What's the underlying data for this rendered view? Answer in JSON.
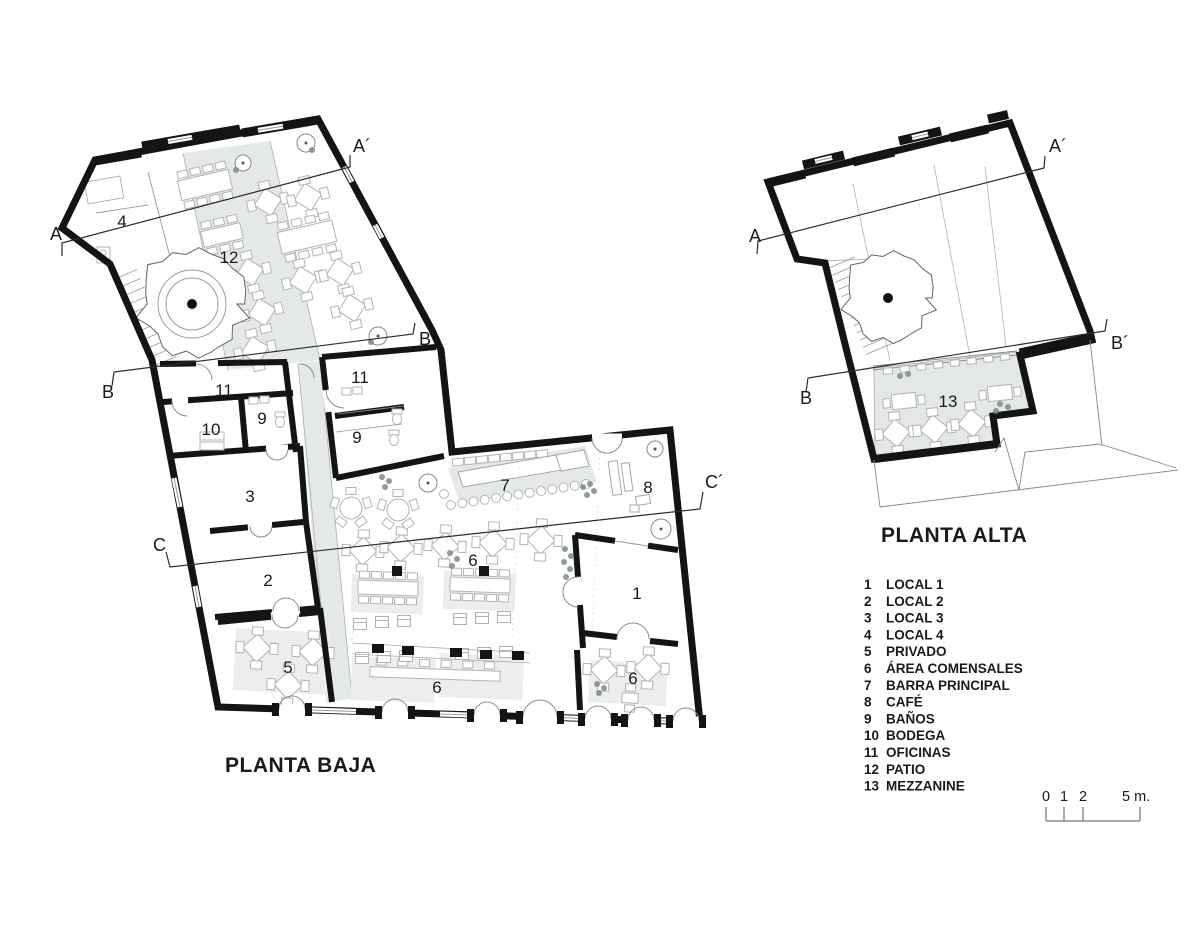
{
  "titles": {
    "ground_floor": "PLANTA BAJA",
    "upper_floor": "PLANTA ALTA"
  },
  "legend": {
    "items": [
      {
        "number": "1",
        "label": "LOCAL 1"
      },
      {
        "number": "2",
        "label": "LOCAL 2"
      },
      {
        "number": "3",
        "label": "LOCAL 3"
      },
      {
        "number": "4",
        "label": "LOCAL 4"
      },
      {
        "number": "5",
        "label": "PRIVADO"
      },
      {
        "number": "6",
        "label": "ÁREA COMENSALES"
      },
      {
        "number": "7",
        "label": "BARRA PRINCIPAL"
      },
      {
        "number": "8",
        "label": "CAFÉ"
      },
      {
        "number": "9",
        "label": "BAÑOS"
      },
      {
        "number": "10",
        "label": "BODEGA"
      },
      {
        "number": "11",
        "label": "OFICINAS"
      },
      {
        "number": "12",
        "label": "PATIO"
      },
      {
        "number": "13",
        "label": "MEZZANINE"
      }
    ]
  },
  "scale_bar": {
    "tick_labels": [
      {
        "text": "0",
        "x": 1042
      },
      {
        "text": "1",
        "x": 1060
      },
      {
        "text": "2",
        "x": 1079
      },
      {
        "text": "5 m.",
        "x": 1122
      }
    ],
    "label_y": 801,
    "ticks_x": [
      1046,
      1064,
      1083,
      1140
    ],
    "tick_top": 807,
    "baseline": {
      "x1": 1046,
      "x2": 1140,
      "y": 821
    }
  },
  "ground_floor": {
    "room_labels": [
      {
        "text": "4",
        "x": 122,
        "y": 227
      },
      {
        "text": "12",
        "x": 229,
        "y": 263
      },
      {
        "text": "11",
        "x": 224,
        "y": 396
      },
      {
        "text": "10",
        "x": 211,
        "y": 435
      },
      {
        "text": "9",
        "x": 262,
        "y": 424
      },
      {
        "text": "11",
        "x": 360,
        "y": 383
      },
      {
        "text": "9",
        "x": 357,
        "y": 443
      },
      {
        "text": "3",
        "x": 250,
        "y": 502
      },
      {
        "text": "2",
        "x": 268,
        "y": 586
      },
      {
        "text": "5",
        "x": 288,
        "y": 673
      },
      {
        "text": "7",
        "x": 505,
        "y": 491
      },
      {
        "text": "8",
        "x": 648,
        "y": 493
      },
      {
        "text": "6",
        "x": 473,
        "y": 566
      },
      {
        "text": "6",
        "x": 437,
        "y": 693
      },
      {
        "text": "6",
        "x": 633,
        "y": 684
      },
      {
        "text": "1",
        "x": 637,
        "y": 599
      }
    ],
    "section_lines": [
      {
        "name": "A",
        "points": [
          [
            62,
            256
          ],
          [
            62,
            243
          ],
          [
            350,
            167
          ],
          [
            350,
            155
          ]
        ],
        "labels": [
          {
            "text": "A",
            "x": 50,
            "y": 240
          },
          {
            "text": "A´",
            "x": 353,
            "y": 152
          }
        ]
      },
      {
        "name": "B",
        "points": [
          [
            112,
            386
          ],
          [
            114,
            372
          ],
          [
            413,
            334
          ],
          [
            415,
            323
          ]
        ],
        "labels": [
          {
            "text": "B",
            "x": 102,
            "y": 398
          },
          {
            "text": "B´",
            "x": 419,
            "y": 345
          }
        ]
      },
      {
        "name": "C",
        "points": [
          [
            166,
            552
          ],
          [
            170,
            567
          ],
          [
            700,
            509
          ],
          [
            703,
            492
          ]
        ],
        "labels": [
          {
            "text": "C",
            "x": 153,
            "y": 551
          },
          {
            "text": "C´",
            "x": 705,
            "y": 488
          }
        ]
      }
    ]
  },
  "upper_floor": {
    "room_labels": [
      {
        "text": "13",
        "x": 948,
        "y": 407
      }
    ],
    "section_lines": [
      {
        "name": "A",
        "points": [
          [
            757,
            254
          ],
          [
            758,
            241
          ],
          [
            1044,
            168
          ],
          [
            1045,
            156
          ]
        ],
        "labels": [
          {
            "text": "A",
            "x": 749,
            "y": 242
          },
          {
            "text": "A´",
            "x": 1049,
            "y": 152
          }
        ]
      },
      {
        "name": "B",
        "points": [
          [
            806,
            392
          ],
          [
            808,
            378
          ],
          [
            1105,
            331
          ],
          [
            1107,
            319
          ]
        ],
        "labels": [
          {
            "text": "B",
            "x": 800,
            "y": 404
          },
          {
            "text": "B´",
            "x": 1111,
            "y": 349
          }
        ]
      }
    ]
  }
}
